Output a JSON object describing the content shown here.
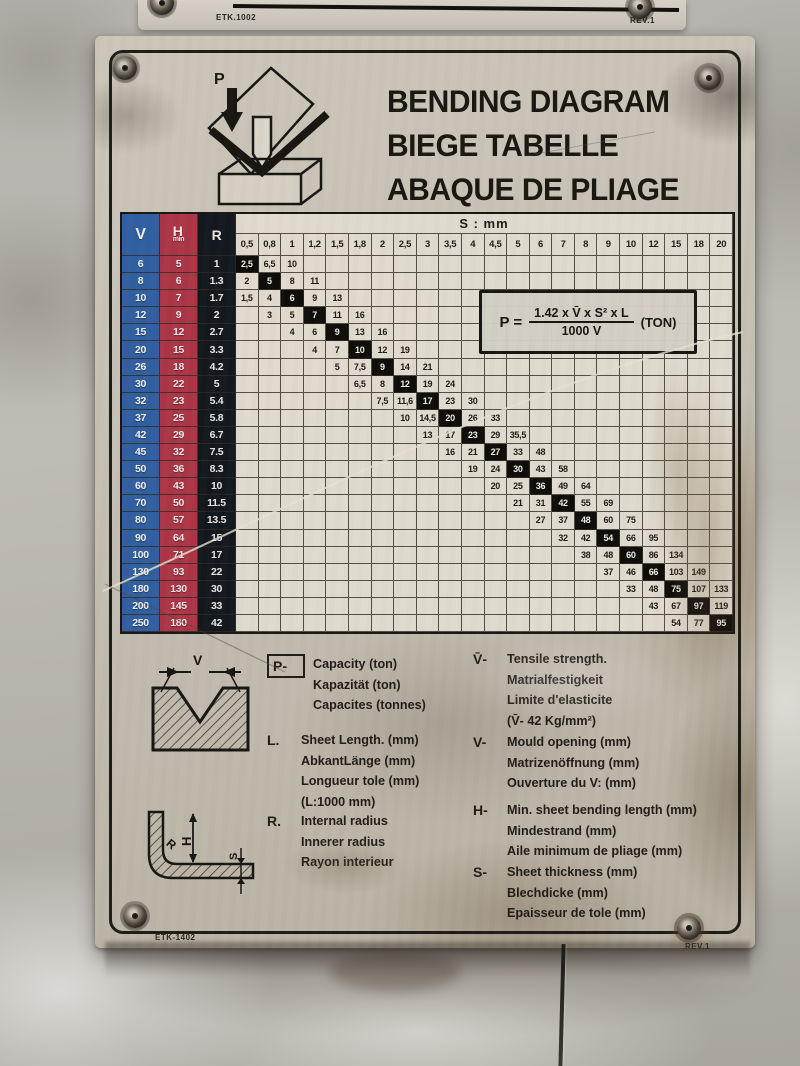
{
  "top_plate": {
    "part_number": "ETK.1002",
    "revision": "REV.1"
  },
  "plate_footer": {
    "part_number": "ETK-1402",
    "revision": "REV.1"
  },
  "title": {
    "lines": [
      "BENDING DIAGRAM",
      "BIEGE TABELLE",
      "ABAQUE DE PLIAGE"
    ]
  },
  "press_icon": {
    "label": "P"
  },
  "formula": {
    "lhs": "P =",
    "numerator": "1.42 x V̄ x S² x L",
    "denominator": "1000 V",
    "unit": "(TON)"
  },
  "colors": {
    "v_column": "#2d5fa2",
    "h_column": "#ae3445",
    "r_column": "#10151d",
    "highlight_cell": "#0b0a08",
    "plate_metal": "#c6c0b4"
  },
  "table": {
    "header": {
      "v": "V",
      "h": "H",
      "h_sub": "min",
      "r": "R",
      "s_group": "S : mm"
    },
    "s_columns": [
      "0,5",
      "0,8",
      "1",
      "1,2",
      "1,5",
      "1,8",
      "2",
      "2,5",
      "3",
      "3,5",
      "4",
      "4,5",
      "5",
      "6",
      "7",
      "8",
      "9",
      "10",
      "12",
      "15",
      "18",
      "20"
    ],
    "rows": [
      {
        "v": "6",
        "h": "5",
        "r": "1",
        "start": 0,
        "values": [
          "2,5",
          "6,5",
          "10"
        ],
        "highlight": 0
      },
      {
        "v": "8",
        "h": "6",
        "r": "1.3",
        "start": 0,
        "values": [
          "2",
          "5",
          "8",
          "11"
        ],
        "highlight": 1
      },
      {
        "v": "10",
        "h": "7",
        "r": "1.7",
        "start": 0,
        "values": [
          "1,5",
          "4",
          "6",
          "9",
          "13"
        ],
        "highlight": 2
      },
      {
        "v": "12",
        "h": "9",
        "r": "2",
        "start": 1,
        "values": [
          "3",
          "5",
          "7",
          "11",
          "16"
        ],
        "highlight": 2
      },
      {
        "v": "15",
        "h": "12",
        "r": "2.7",
        "start": 2,
        "values": [
          "4",
          "6",
          "9",
          "13",
          "16"
        ],
        "highlight": 2
      },
      {
        "v": "20",
        "h": "15",
        "r": "3.3",
        "start": 3,
        "values": [
          "4",
          "7",
          "10",
          "12",
          "19"
        ],
        "highlight": 2
      },
      {
        "v": "26",
        "h": "18",
        "r": "4.2",
        "start": 4,
        "values": [
          "5",
          "7,5",
          "9",
          "14",
          "21"
        ],
        "highlight": 2
      },
      {
        "v": "30",
        "h": "22",
        "r": "5",
        "start": 5,
        "values": [
          "6,5",
          "8",
          "12",
          "19",
          "24"
        ],
        "highlight": 2
      },
      {
        "v": "32",
        "h": "23",
        "r": "5.4",
        "start": 6,
        "values": [
          "7,5",
          "11,6",
          "17",
          "23",
          "30"
        ],
        "highlight": 2
      },
      {
        "v": "37",
        "h": "25",
        "r": "5.8",
        "start": 7,
        "values": [
          "10",
          "14,5",
          "20",
          "26",
          "33"
        ],
        "highlight": 2
      },
      {
        "v": "42",
        "h": "29",
        "r": "6.7",
        "start": 8,
        "values": [
          "13",
          "17",
          "23",
          "29",
          "35,5"
        ],
        "highlight": 2
      },
      {
        "v": "45",
        "h": "32",
        "r": "7.5",
        "start": 9,
        "values": [
          "16",
          "21",
          "27",
          "33",
          "48"
        ],
        "highlight": 2
      },
      {
        "v": "50",
        "h": "36",
        "r": "8.3",
        "start": 10,
        "values": [
          "19",
          "24",
          "30",
          "43",
          "58"
        ],
        "highlight": 2
      },
      {
        "v": "60",
        "h": "43",
        "r": "10",
        "start": 11,
        "values": [
          "20",
          "25",
          "36",
          "49",
          "64"
        ],
        "highlight": 2
      },
      {
        "v": "70",
        "h": "50",
        "r": "11.5",
        "start": 12,
        "values": [
          "21",
          "31",
          "42",
          "55",
          "69"
        ],
        "highlight": 2
      },
      {
        "v": "80",
        "h": "57",
        "r": "13.5",
        "start": 13,
        "values": [
          "27",
          "37",
          "48",
          "60",
          "75"
        ],
        "highlight": 2
      },
      {
        "v": "90",
        "h": "64",
        "r": "15",
        "start": 14,
        "values": [
          "32",
          "42",
          "54",
          "66",
          "95"
        ],
        "highlight": 2
      },
      {
        "v": "100",
        "h": "71",
        "r": "17",
        "start": 15,
        "values": [
          "38",
          "48",
          "60",
          "86",
          "134"
        ],
        "highlight": 2
      },
      {
        "v": "130",
        "h": "93",
        "r": "22",
        "start": 16,
        "values": [
          "37",
          "46",
          "66",
          "103",
          "149"
        ],
        "highlight": 2
      },
      {
        "v": "180",
        "h": "130",
        "r": "30",
        "start": 17,
        "values": [
          "33",
          "48",
          "75",
          "107",
          "133"
        ],
        "highlight": 2
      },
      {
        "v": "200",
        "h": "145",
        "r": "33",
        "start": 18,
        "values": [
          "43",
          "67",
          "97",
          "119"
        ],
        "highlight": 2
      },
      {
        "v": "250",
        "h": "180",
        "r": "42",
        "start": 19,
        "values": [
          "54",
          "77",
          "95"
        ],
        "highlight": 2
      }
    ]
  },
  "legend": {
    "die_icon_label": "V",
    "angle_icon_labels": {
      "r": "R",
      "h": "H",
      "s": "S"
    },
    "left": [
      {
        "symbol": "P-",
        "boxed": true,
        "lines": [
          "Capacity (ton)",
          "Kapazität (ton)",
          "Capacites (tonnes)"
        ]
      },
      {
        "symbol": "L.",
        "boxed": false,
        "lines": [
          "Sheet Length. (mm)",
          "AbkantLänge (mm)",
          "Longueur tole (mm)",
          "(L:1000 mm)"
        ]
      },
      {
        "symbol": "R.",
        "boxed": false,
        "lines": [
          "Internal radius",
          "Innerer radius",
          "Rayon interieur"
        ]
      }
    ],
    "right": [
      {
        "symbol": "V̄-",
        "boxed": false,
        "lines": [
          "Tensile strength.",
          "Matrialfestigkeit",
          "Limite d'elasticite",
          "(V̄- 42 Kg/mm²)"
        ]
      },
      {
        "symbol": "V-",
        "boxed": false,
        "lines": [
          "Mould opening (mm)",
          "Matrizenöffnung (mm)",
          "Ouverture du V: (mm)"
        ]
      },
      {
        "symbol": "H-",
        "boxed": false,
        "lines": [
          "Min. sheet bending length (mm)",
          "Mindestrand (mm)",
          "Aile minimum de pliage (mm)"
        ]
      },
      {
        "symbol": "S-",
        "boxed": false,
        "lines": [
          "Sheet thickness (mm)",
          "Blechdicke (mm)",
          "Epaisseur de tole (mm)"
        ]
      }
    ]
  }
}
